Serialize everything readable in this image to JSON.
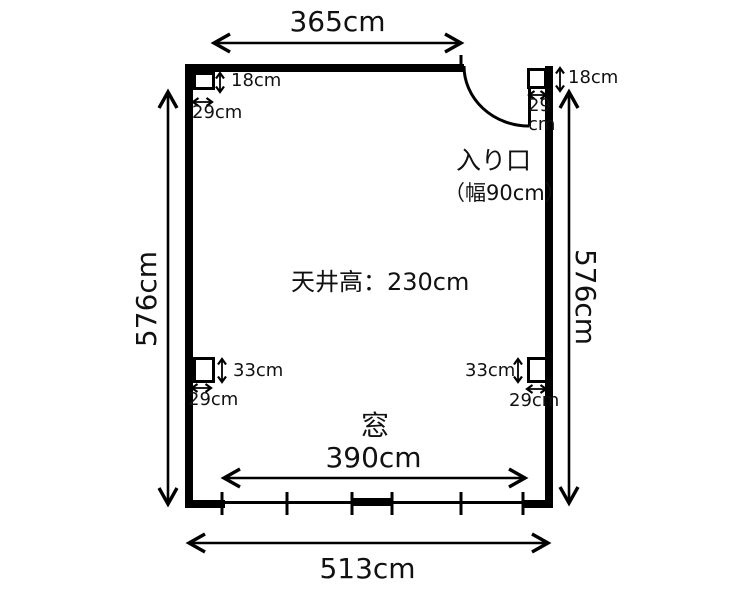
{
  "diagram": {
    "type": "room-floor-plan",
    "room": {
      "top_width": "365cm",
      "bottom_width": "513cm",
      "left_height": "576cm",
      "right_height": "576cm",
      "ceiling_label": "天井高：230cm"
    },
    "entrance": {
      "label": "入り口",
      "width_label": "（幅90cm）"
    },
    "window": {
      "label": "窓",
      "width_label": "390cm"
    },
    "pillars": {
      "top_left": {
        "depth": "18cm",
        "width": "29cm"
      },
      "top_right": {
        "depth": "18cm",
        "width": "29\ncm"
      },
      "bottom_left": {
        "depth": "33cm",
        "width": "29cm"
      },
      "bottom_right": {
        "depth": "33cm",
        "width": "29cm"
      }
    },
    "colors": {
      "line": "#000000",
      "text": "#111111",
      "background": "#ffffff"
    }
  }
}
